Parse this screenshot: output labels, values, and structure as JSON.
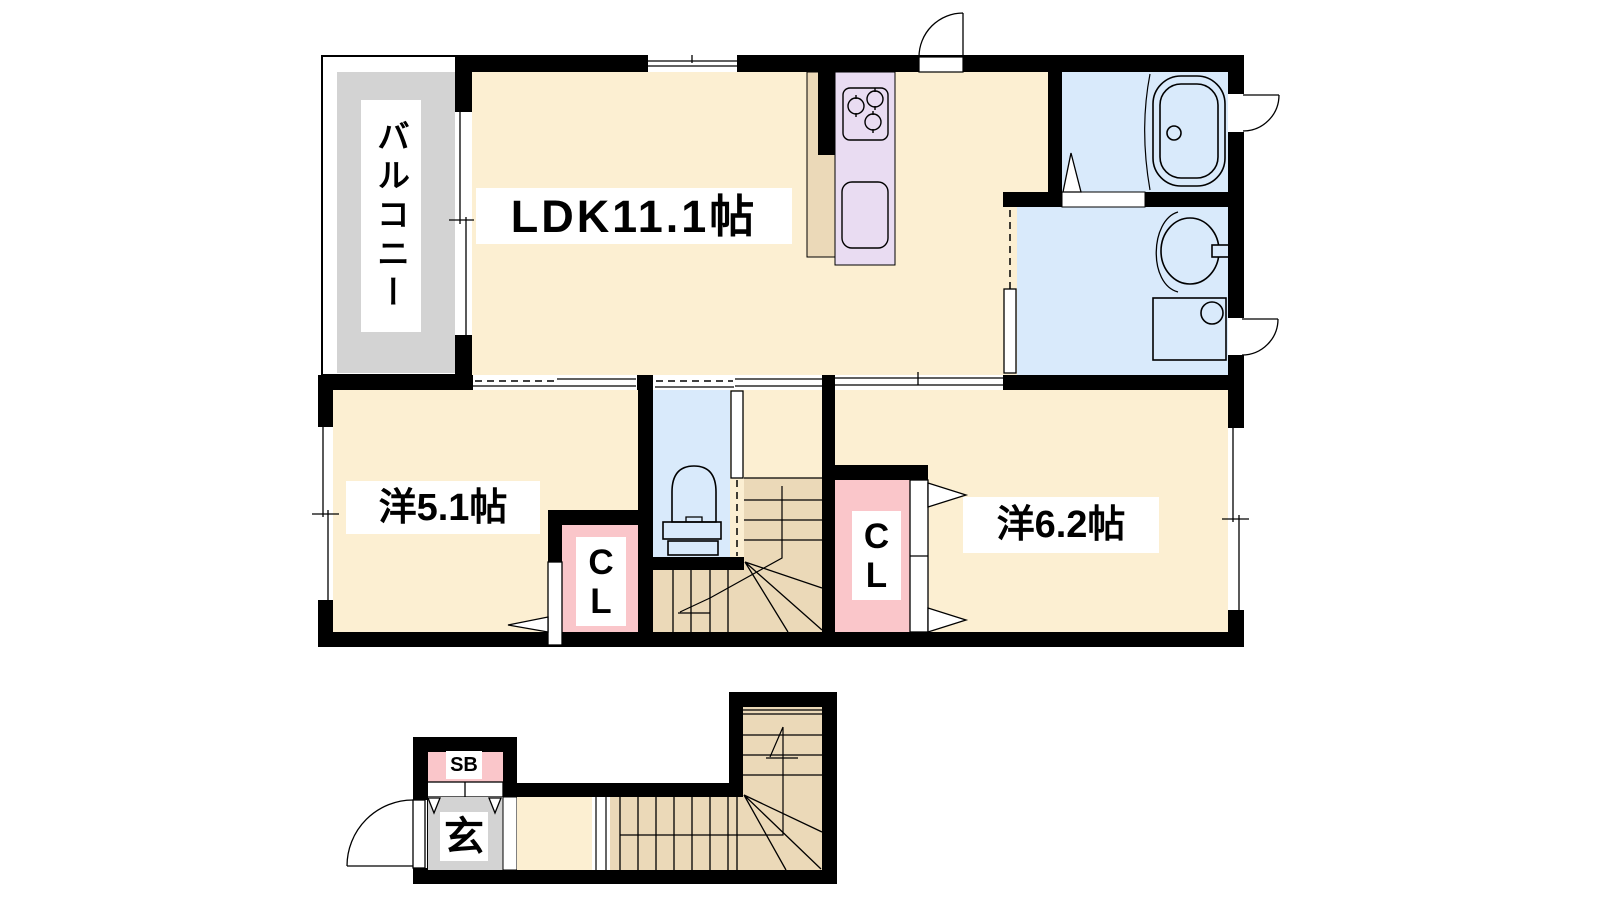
{
  "rooms": {
    "balcony": {
      "label": "バルコニー"
    },
    "ldk": {
      "label": "LDK11.1帖"
    },
    "western_5_1": {
      "label": "洋5.1帖"
    },
    "western_6_2": {
      "label": "洋6.2帖"
    },
    "closet_5_1": {
      "label": "CL"
    },
    "closet_6_2": {
      "label": "CL"
    },
    "shoe_box": {
      "label": "SB"
    },
    "entrance": {
      "label": "玄"
    }
  },
  "fixtures": [
    "bathtub",
    "vanity-sink",
    "washing-machine-pan",
    "toilet",
    "kitchen-stove",
    "kitchen-sink",
    "upper-staircase",
    "lower-staircase",
    "entry-door",
    "swing-door",
    "sliding-doors",
    "windows"
  ],
  "colors": {
    "wall": "#000000",
    "room_floor": "#FCEFD2",
    "stairs": "#EBD9B8",
    "balcony_floor": "#D3D3D3",
    "kitchen_counter": "#E9DCF2",
    "wet_area": "#D9EAFB",
    "closet": "#FAC6CA",
    "background": "#FFFFFF"
  }
}
